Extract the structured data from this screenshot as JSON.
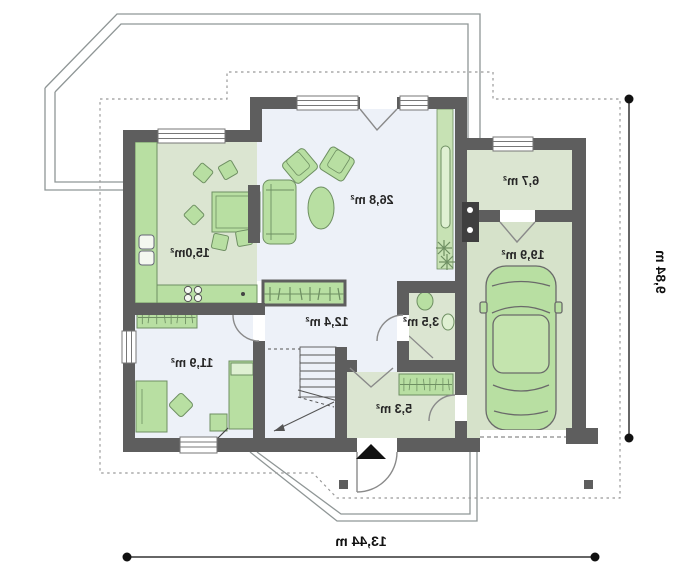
{
  "plan": {
    "type": "floor-plan",
    "rooms": [
      {
        "id": "living-room",
        "area_label": "26,8 m²"
      },
      {
        "id": "kitchen-dining",
        "area_label": "15,0m²"
      },
      {
        "id": "utility-room",
        "area_label": "6,7 m²"
      },
      {
        "id": "garage",
        "area_label": "19,9 m²"
      },
      {
        "id": "hall",
        "area_label": "12,4 m²"
      },
      {
        "id": "wc",
        "area_label": "3,5 m²"
      },
      {
        "id": "vestibule",
        "area_label": "5,3 m²"
      },
      {
        "id": "bedroom",
        "area_label": "11,9 m²"
      }
    ],
    "dimensions": {
      "overall_width": "13,44 m",
      "overall_depth": "9,84 m"
    },
    "rendering": {
      "labels_mirrored": true
    },
    "colors": {
      "wall": "#5e5e5e",
      "room_green": "#dbe5d1",
      "room_light": "#edf1f8",
      "furniture": "#b8dfa2",
      "furniture_light": "#dff0d2",
      "outline_gray": "#8f9696",
      "dash_gray": "#999999",
      "dimension": "#111111"
    },
    "icons": {
      "entrance_marker": "triangle-up-icon",
      "stairs": "stair-flight",
      "car": "car-top-view",
      "plant": "plant-asterisk",
      "boiler": "boiler-unit"
    }
  }
}
